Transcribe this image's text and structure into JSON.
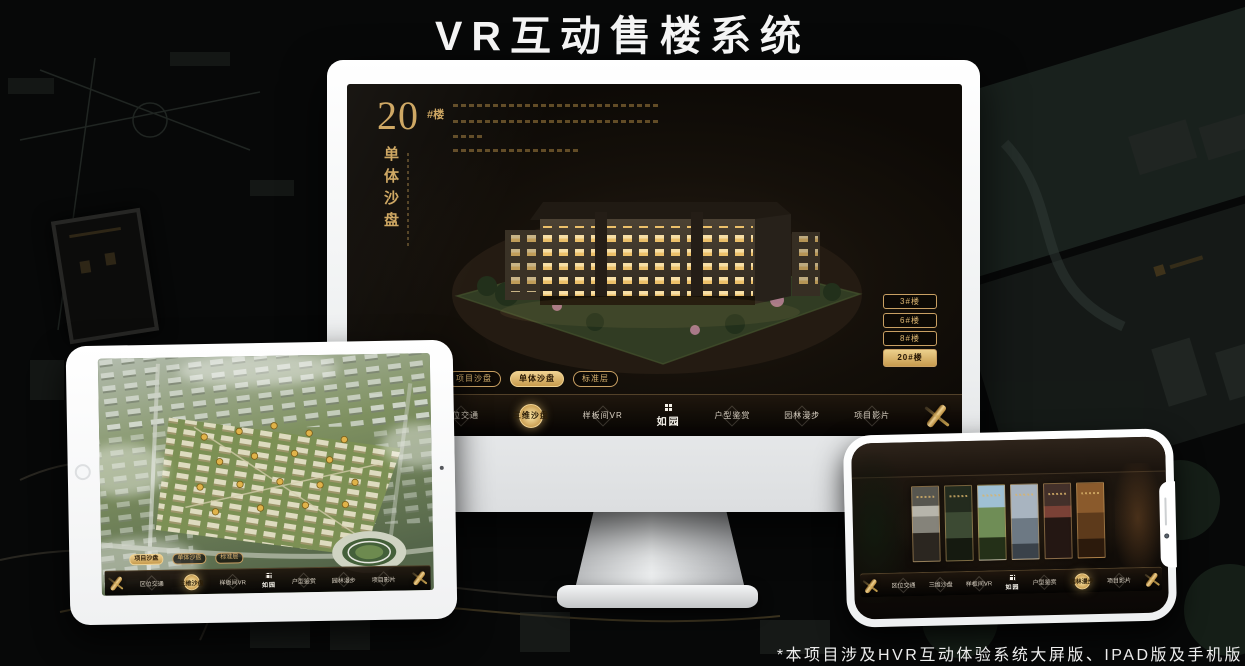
{
  "page": {
    "title": "VR互动售楼系统",
    "footnote": "*本项目涉及HVR互动体验系统大屏版、IPAD版及手机版"
  },
  "logo": {
    "name": "如园"
  },
  "colors": {
    "gold": "#d9b36a",
    "gold_deep": "#c79b4e",
    "screen_bg": "#100c08"
  },
  "nav": {
    "items": [
      {
        "label": "区位交通"
      },
      {
        "label": "三维沙盘"
      },
      {
        "label": "样板间VR"
      },
      {
        "label": "户型鉴赏"
      },
      {
        "label": "园林漫步"
      },
      {
        "label": "项目影片"
      }
    ]
  },
  "tabs": {
    "items": [
      {
        "label": "项目沙盘"
      },
      {
        "label": "单体沙盘"
      },
      {
        "label": "标准层"
      }
    ]
  },
  "desktop": {
    "heading_number": "20",
    "heading_suffix": "#楼",
    "heading_sub": "单体沙盘",
    "active_tab": "单体沙盘",
    "active_nav": "三维沙盘",
    "floor_buttons": [
      {
        "label": "3#楼",
        "active": false
      },
      {
        "label": "6#楼",
        "active": false
      },
      {
        "label": "8#楼",
        "active": false
      },
      {
        "label": "20#楼",
        "active": true
      }
    ]
  },
  "ipad": {
    "active_tab": "项目沙盘",
    "active_nav": "三维沙盘"
  },
  "phone": {
    "active_nav": "园林漫步",
    "gallery_panels": 6
  }
}
